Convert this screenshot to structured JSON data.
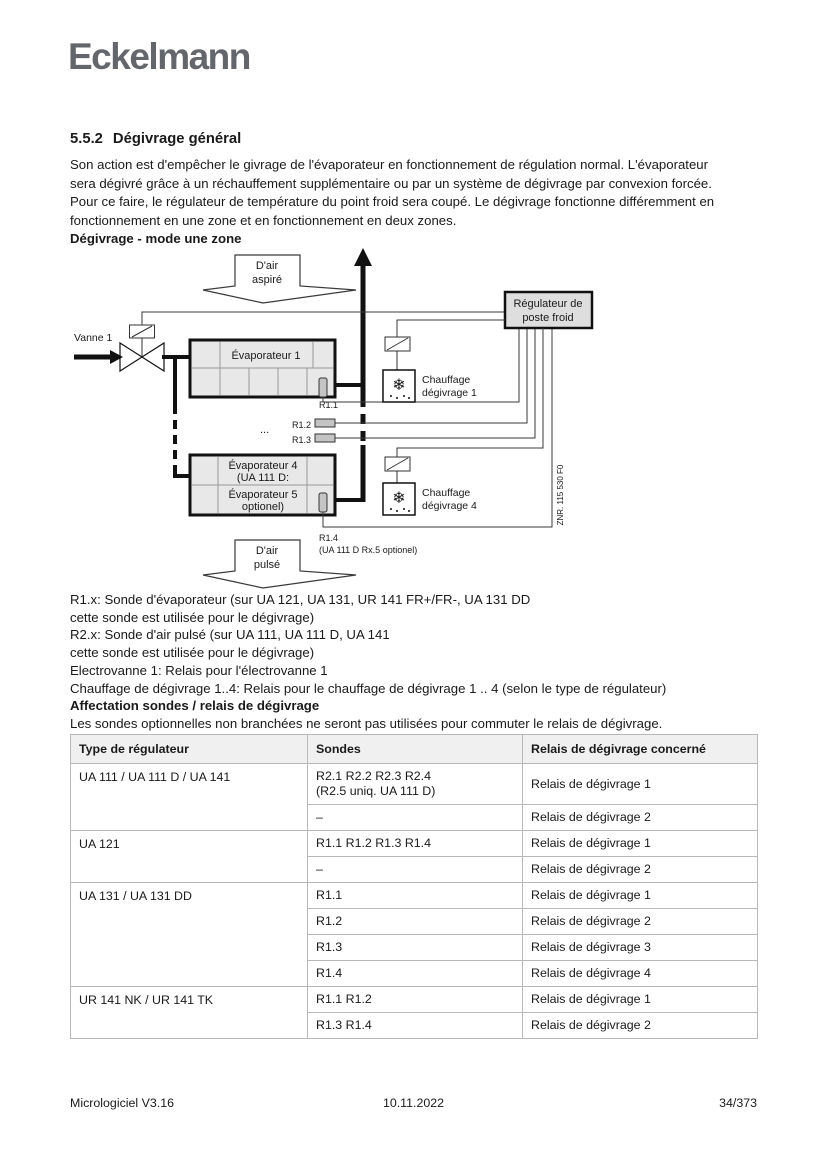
{
  "logo": "Eckelmann",
  "section": {
    "number": "5.5.2",
    "title": "Dégivrage général"
  },
  "intro": {
    "lines": [
      "Son action est d'empêcher le givrage de l'évaporateur en fonctionnement de régulation normal. L'évaporateur",
      "sera dégivré grâce à un réchauffement supplémentaire ou par un système de dégivrage par convexion forcée.",
      "Pour ce faire, le régulateur de température du point froid sera coupé. Le dégivrage fonctionne différemment en",
      "fonctionnement en une zone et en fonctionnement en deux zones."
    ],
    "subtitle": "Dégivrage - mode une zone"
  },
  "diagram": {
    "air_in": {
      "l1": "D'air",
      "l2": "aspiré"
    },
    "air_out": {
      "l1": "D'air",
      "l2": "pulsé"
    },
    "valve_label": "Vanne 1",
    "regulator": {
      "l1": "Régulateur de",
      "l2": "poste froid"
    },
    "evap1": "Évaporateur 1",
    "evap45": {
      "l1": "Évaporateur 4",
      "l2": "(UA 111 D:",
      "l3": "Évaporateur 5",
      "l4": "optionel)"
    },
    "heater1": {
      "l1": "Chauffage",
      "l2": "dégivrage 1"
    },
    "heater4": {
      "l1": "Chauffage",
      "l2": "dégivrage 4"
    },
    "r11": "R1.1",
    "r12": "R1.2",
    "r13": "R1.3",
    "r14": "R1.4",
    "r14_note": "(UA 111 D Rx.5 optionel)",
    "dots": "...",
    "part_number": "ZNR. 115 530 F0",
    "snowflake": "❄"
  },
  "legend": {
    "lines": [
      "R1.x: Sonde d'évaporateur (sur UA 121, UA 131, UR 141 FR+/FR-, UA 131 DD",
      "cette sonde est utilisée pour le dégivrage)",
      "R2.x: Sonde d'air pulsé (sur UA 111, UA 111 D, UA 141",
      "cette sonde est utilisée pour le dégivrage)",
      "Electrovanne 1: Relais pour l'électrovanne 1",
      "Chauffage de dégivrage 1..4: Relais pour le chauffage de dégivrage 1 .. 4 (selon le type de régulateur)"
    ],
    "heading": "Affectation sondes / relais de dégivrage",
    "note": "Les sondes optionnelles non branchées ne seront pas utilisées pour commuter le relais de dégivrage."
  },
  "table": {
    "headers": [
      "Type de régulateur",
      "Sondes",
      "Relais de dégivrage concerné"
    ],
    "groups": [
      {
        "type": "UA 111 / UA 111 D / UA 141",
        "rows": [
          {
            "sondes": "R2.1 R2.2 R2.3 R2.4",
            "sondes2": "(R2.5 uniq. UA 111 D)",
            "relais": "Relais de dégivrage 1"
          },
          {
            "sondes": "–",
            "sondes2": "",
            "relais": "Relais de dégivrage 2"
          }
        ]
      },
      {
        "type": "UA 121",
        "rows": [
          {
            "sondes": "R1.1 R1.2 R1.3 R1.4",
            "sondes2": "",
            "relais": "Relais de dégivrage 1"
          },
          {
            "sondes": "–",
            "sondes2": "",
            "relais": "Relais de dégivrage 2"
          }
        ]
      },
      {
        "type": "UA 131 / UA 131 DD",
        "rows": [
          {
            "sondes": "R1.1",
            "sondes2": "",
            "relais": "Relais de dégivrage 1"
          },
          {
            "sondes": "R1.2",
            "sondes2": "",
            "relais": "Relais de dégivrage 2"
          },
          {
            "sondes": "R1.3",
            "sondes2": "",
            "relais": "Relais de dégivrage 3"
          },
          {
            "sondes": "R1.4",
            "sondes2": "",
            "relais": "Relais de dégivrage 4"
          }
        ]
      },
      {
        "type": "UR 141 NK / UR 141 TK",
        "rows": [
          {
            "sondes": "R1.1 R1.2",
            "sondes2": "",
            "relais": "Relais de dégivrage 1"
          },
          {
            "sondes": "R1.3 R1.4",
            "sondes2": "",
            "relais": "Relais de dégivrage 2"
          }
        ]
      }
    ]
  },
  "footer": {
    "left": "Micrologiciel V3.16",
    "center": "10.11.2022",
    "right": "34/373"
  },
  "colors": {
    "logo_gray": "#63676b",
    "evaporator_fill": "#e8e8e8",
    "regulator_fill": "#dedede",
    "table_header_bg": "#f0f0f0",
    "table_border": "#b8b8b8"
  }
}
